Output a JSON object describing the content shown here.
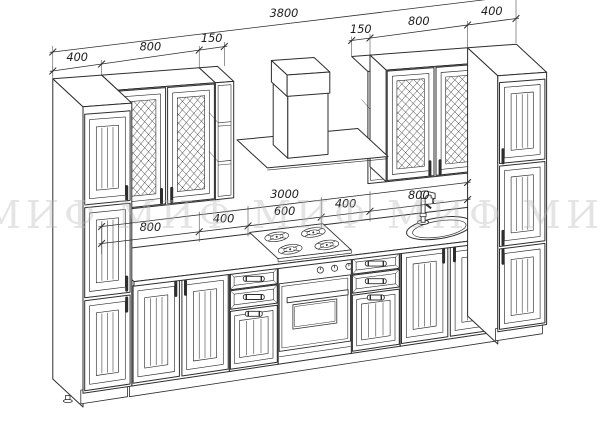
{
  "colors": {
    "ink": "#2e2e2e",
    "paper": "#ffffff",
    "watermark": "#dedede"
  },
  "watermark": {
    "text": "МИФ",
    "repeats": 5
  },
  "dimensions": {
    "total": "3800",
    "upper_left": [
      "400",
      "800",
      "150"
    ],
    "upper_right": [
      "150",
      "800",
      "400"
    ],
    "counter_total": "3000",
    "counter_segments": [
      "800",
      "400",
      "600",
      "400",
      "800"
    ]
  }
}
